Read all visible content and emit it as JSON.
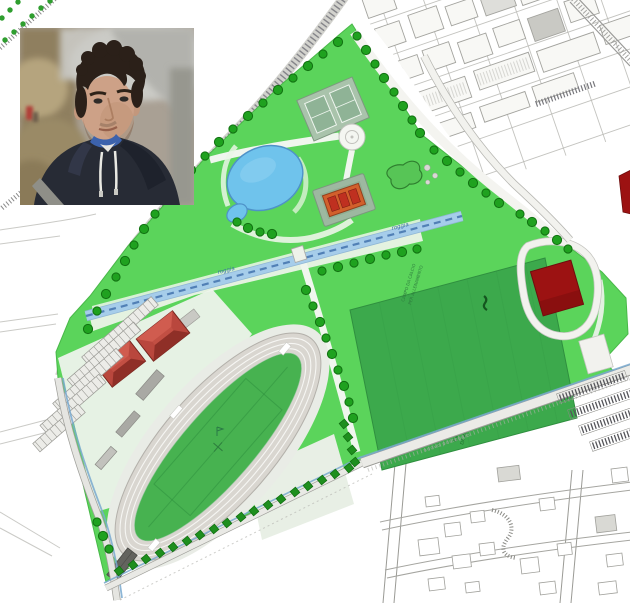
{
  "page": {
    "background": "#ffffff"
  },
  "photo_inset": {
    "description": "young man with short dark curly hair and light stubble wearing a dark hooded sweatshirt with blue inner collar and white drawstrings, outdoors, blurred background",
    "colors": {
      "hair": "#2b2019",
      "skin": "#cda187",
      "hoodie": "#272b35",
      "collar": "#3c62ac",
      "drawstring": "#e9e9e3"
    }
  },
  "map": {
    "labels": {
      "canal": "roggia",
      "training_field_line1": "CAMPO DA CALCIO",
      "training_field_line2": "PER ALLENAMENTO",
      "main_field_line1": "CAMPO",
      "main_field_line2": "DA RUGBY",
      "se_road": "nuovo posteggio"
    },
    "colors": {
      "park_green": "#5bd45b",
      "pale_green": "#c9eec2",
      "path_white": "#f0f6ee",
      "esplanade": "#e4f2e0",
      "field_dark_green": "#3ca94c",
      "infield_green": "#47b250",
      "tree_fill": "#1fa11f",
      "tree_stroke": "#117111",
      "tree_square": "#1e8f1e",
      "pond_blue": "#6fc3ec",
      "pond_stroke": "#4e92c8",
      "canal_blue": "#a6cdea",
      "canal_dash": "#4878b0",
      "ditch_blue": "#79a9cf",
      "track_gray": "#d9d6d0",
      "track_line": "#f6f6f3",
      "track_edge": "#b3b0aa",
      "roof_red": "#b9473d",
      "roof_red_light": "#d05c4f",
      "roof_red_dark": "#8f2f27",
      "dark_red": "#9c1212",
      "orange_roof": "#d2602c",
      "orange_red": "#bf3020",
      "court_pad": "#9db8a0",
      "urban_line": "#a3a39e",
      "urban_fill": "#f8f8f5",
      "urban_dark": "#c9c9c4",
      "road_gray": "#8f8f8a",
      "label_blue": "#3a6ea8",
      "label_green": "#2f7f3f",
      "label_road": "#9aa59a"
    }
  }
}
